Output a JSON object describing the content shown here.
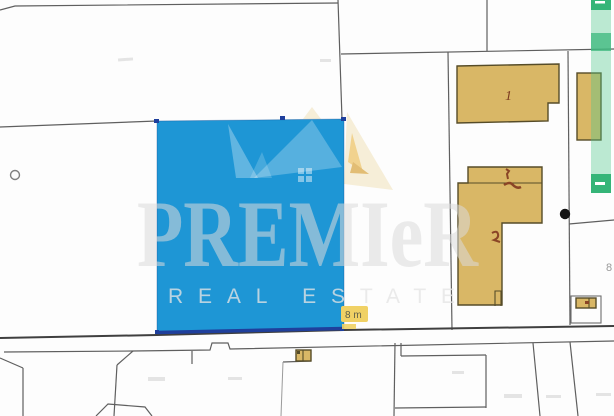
{
  "watermark": {
    "title": "PREMIeR",
    "subtitle": "REAL ESTATE"
  },
  "labels": {
    "building_number": "1",
    "measurement": "8 m",
    "edge_number": "8"
  },
  "icons": {
    "strip_top": "minus-icon",
    "strip_bottom": "minus-icon",
    "point_marker": "dot-marker-icon",
    "circle_marker": "circle-marker-icon"
  },
  "colors": {
    "blue": "#1e96d5",
    "navy": "#1f3f9c",
    "tan": "#d9b766",
    "tan_border": "#564c28",
    "green_dark": "#35b578",
    "green_mid": "#3eba80",
    "yellow": "#f0d165",
    "line": "#5f5f5f",
    "road": "#3f3f3f",
    "watermark_gray": "#e7e7e7",
    "cream": "#f6eed8"
  }
}
